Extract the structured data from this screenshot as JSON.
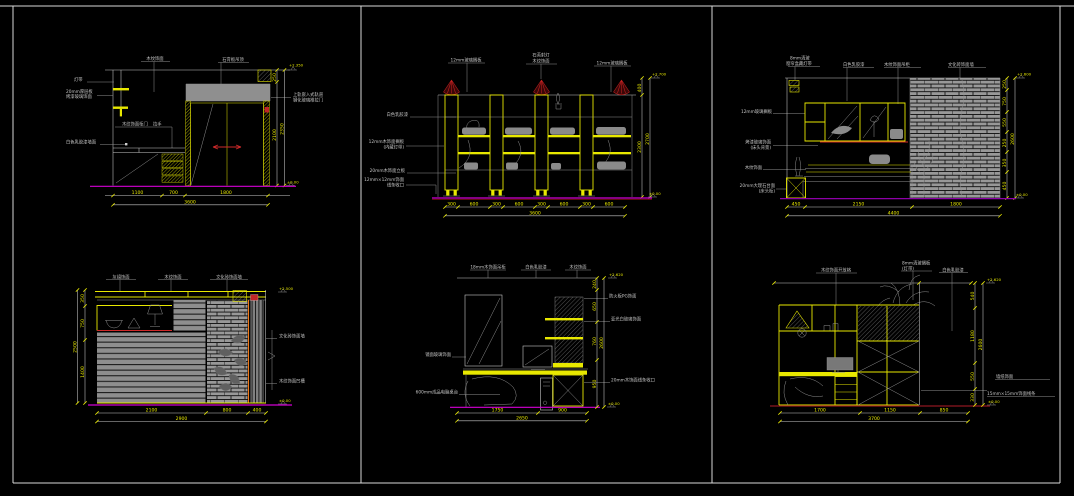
{
  "colors": {
    "background": "#000000",
    "frame": "#d9d9d9",
    "linework_yellow": "#e8e800",
    "linework_white": "#c9c9c9",
    "dimension_text": "#e8e800",
    "baseline_magenta": "#d400d4",
    "accent_red": "#cf2a2a",
    "fill_grey": "#8f8f8f"
  },
  "panels": [
    {
      "top_labels": [
        "木纹饰面",
        "石膏板吊顶"
      ],
      "left_labels": [
        "灯带",
        "20mm厚层板",
        "烤漆玻璃饰面",
        "白色乳胶漆墙面"
      ],
      "inner_labels": [
        "木纹饰面柜门",
        "拉手"
      ],
      "right_labels": [
        "上轨嵌入式轨道",
        "钢化玻璃推拉门"
      ],
      "right_dims": [
        "250",
        "2100"
      ],
      "right_total": "2350",
      "level_top": "+2.350",
      "level_bottom": "±0.00",
      "bottom_dims": [
        "1100",
        "700",
        "1800"
      ],
      "bottom_total": "3600"
    },
    {
      "top_labels": [
        "12mm玻璃搁板",
        "石英射灯",
        "木纹饰面",
        "12mm玻璃搁板"
      ],
      "left_labels": [
        "白色乳胶漆",
        "12mm木饰面搁板",
        "(内藏灯带)",
        "20mm木饰面立板",
        "12mm×12mm饰面",
        "线条收口"
      ],
      "right_dims": [
        "400",
        "2300"
      ],
      "right_total": "2700",
      "level_top": "+2.700",
      "level_bottom": "±0.00",
      "bottom_dims": [
        "300",
        "600",
        "300",
        "600",
        "300",
        "600",
        "300",
        "600"
      ],
      "bottom_total": "3600"
    },
    {
      "top_labels": [
        "8mm清玻",
        "窗帘盒藏灯带",
        "白色乳胶漆",
        "木纹饰面吊柜",
        "文化砖饰面墙"
      ],
      "left_labels": [
        "12mm玻璃搁板",
        "烤漆玻璃饰面",
        "(床头背景)",
        "木纹饰面",
        "20mm大理石台面",
        "(床头柜)"
      ],
      "right_dims": [
        "250",
        "750",
        "550",
        "250",
        "350",
        "450"
      ],
      "right_total": "2600",
      "level_top": "+2.600",
      "level_bottom": "±0.00",
      "bottom_dims": [
        "450",
        "2150",
        "1800"
      ],
      "bottom_total": "4400"
    },
    {
      "top_labels": [
        "灰镜饰面",
        "木纹饰面",
        "文化砖饰面墙"
      ],
      "right_labels": [
        "文化砖饰面墙",
        "木纹饰面凹槽"
      ],
      "left_dims": [
        "350",
        "750",
        "1400"
      ],
      "left_total": "2500",
      "level_top": "+2.500",
      "level_bottom": "±0.00",
      "bottom_dims": [
        "2100",
        "800",
        "400"
      ],
      "bottom_total": "2900"
    },
    {
      "top_labels": [
        "18mm木饰面吊柜",
        "白色乳胶漆",
        "木纹饰面"
      ],
      "left_labels": [
        "镜面玻璃饰面",
        "600mm成品电脑桌台"
      ],
      "right_labels": [
        "防火板PG饰面",
        "亚光白玻璃饰面",
        "20mm木饰面线条收口"
      ],
      "right_dims": [
        "240",
        "650",
        "760",
        "950"
      ],
      "right_total": "2600",
      "level_top": "+2.620",
      "level_bottom": "±0.00",
      "bottom_dims": [
        "1750",
        "900"
      ],
      "bottom_total": "2650"
    },
    {
      "top_labels": [
        "木纹饰面开放格",
        "8mm清玻搁板",
        "(灯带)",
        "白色乳胶漆"
      ],
      "right_labels": [
        "墙纸饰面",
        "15mm×15mm饰面线条"
      ],
      "right_dims": [
        "540",
        "1180",
        "550",
        "330"
      ],
      "right_total": "2600",
      "level_top": "+2.620",
      "level_bottom": "±0.00",
      "bottom_dims": [
        "1700",
        "1150",
        "850"
      ],
      "bottom_total": "3700"
    }
  ]
}
